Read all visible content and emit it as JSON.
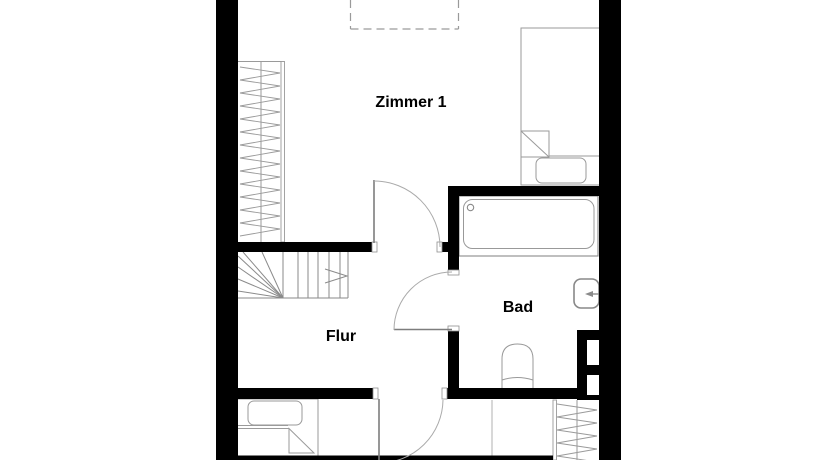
{
  "plan": {
    "type": "floor-plan",
    "rooms": [
      {
        "label": "Zimmer 1"
      },
      {
        "label": "Flur"
      },
      {
        "label": "Bad"
      }
    ],
    "fixtures": [
      "skylight-dashed-outline",
      "wardrobe-left",
      "wardrobe-bottom-right",
      "staircase-winder-with-up-arrow",
      "bed-top-right",
      "bed-bottom-left",
      "bathtub",
      "washbasin",
      "toilet",
      "chimney-shaft",
      "door-zimmer1",
      "door-bad",
      "door-bottom-room"
    ],
    "colors": {
      "wall": "#000000",
      "furniture_line": "#8f8f8f",
      "light_line": "#a8a8a8",
      "background": "#ffffff",
      "label": "#000000"
    }
  }
}
